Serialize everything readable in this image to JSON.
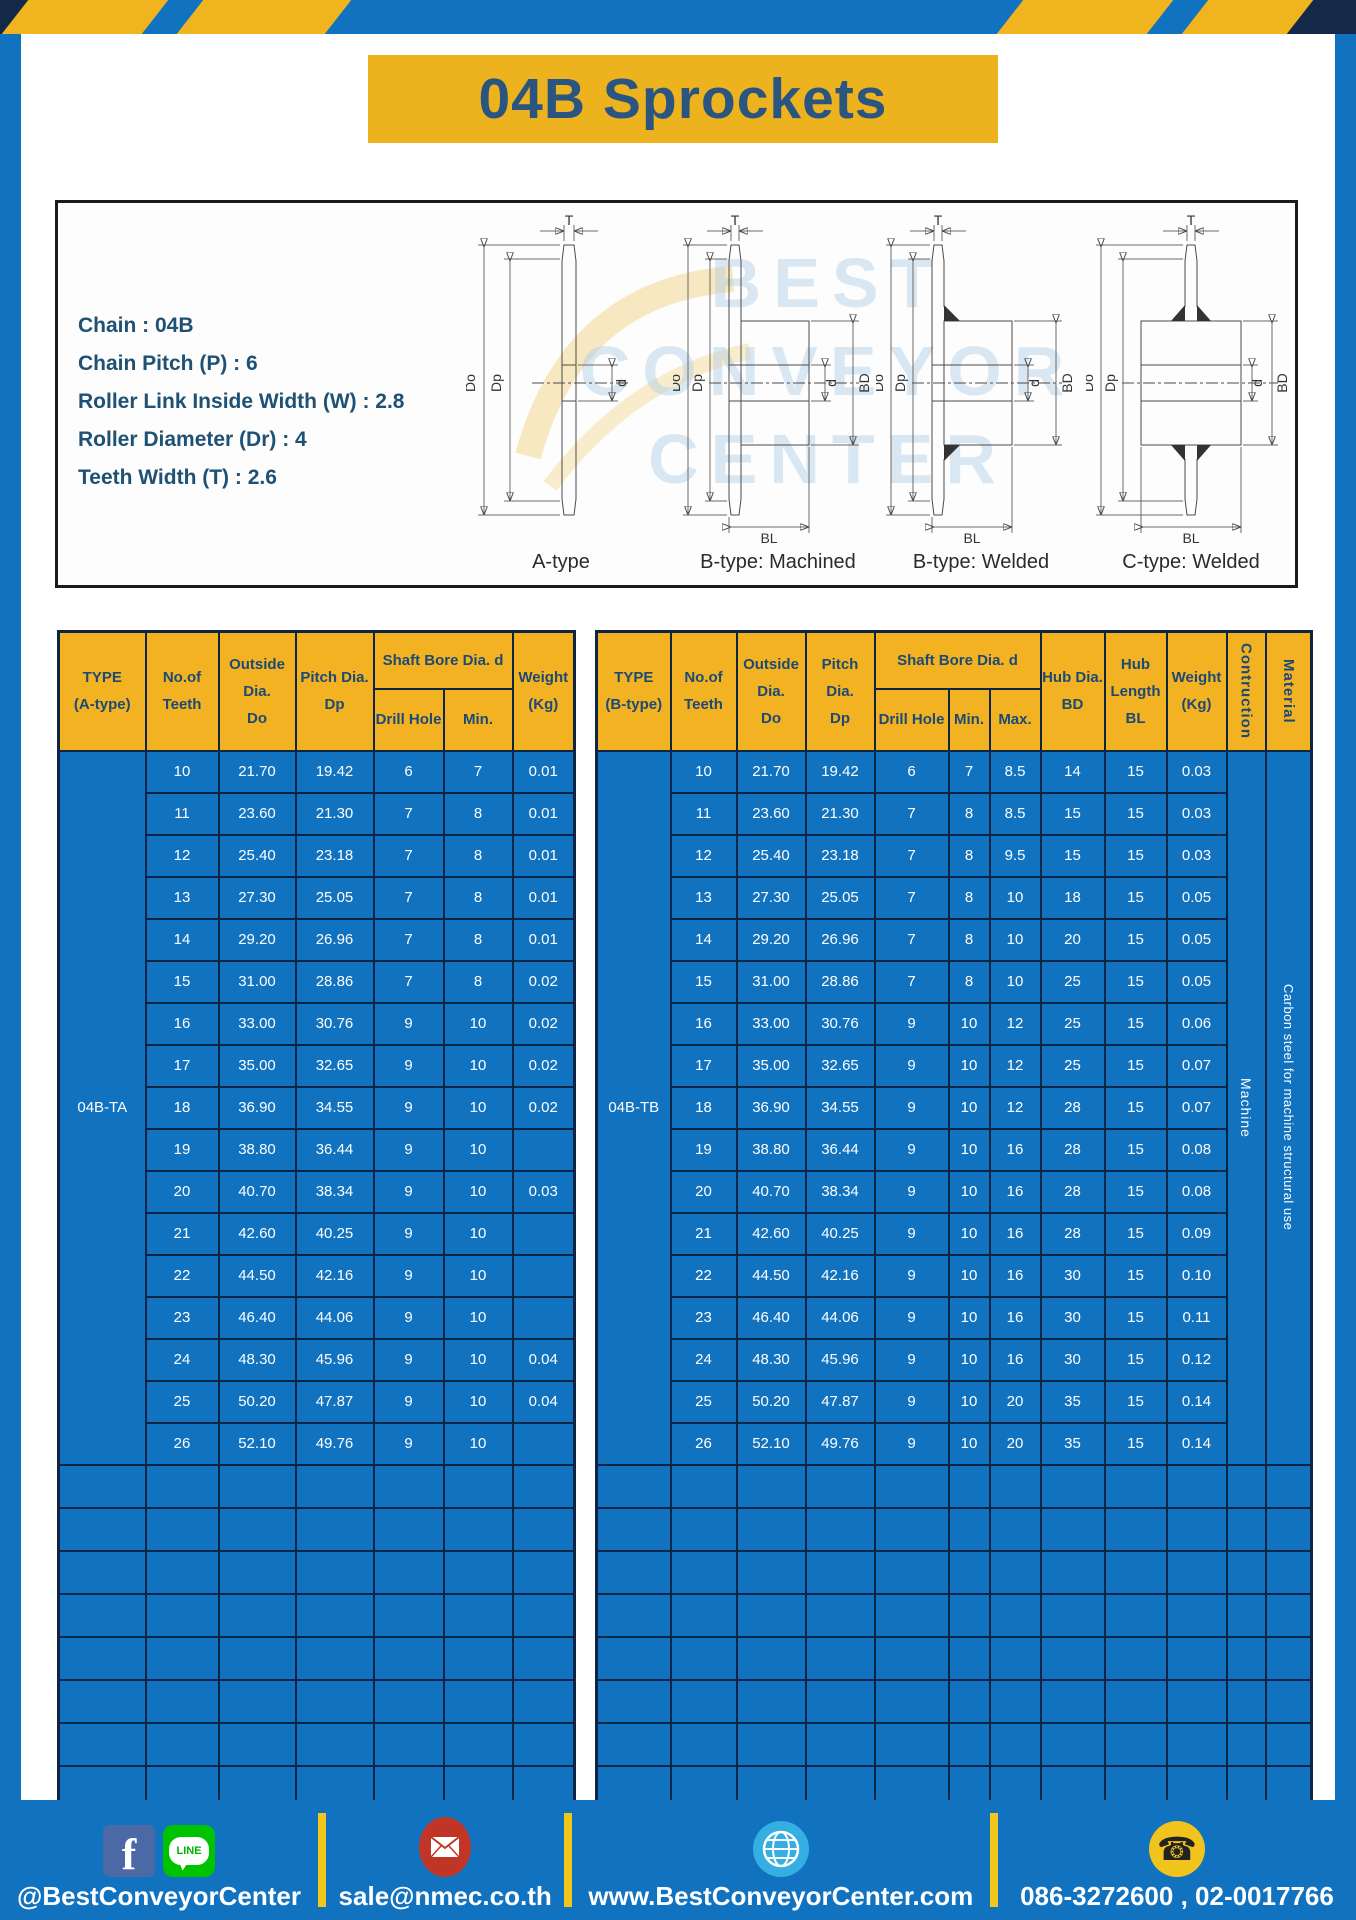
{
  "title": "04B Sprockets",
  "specs": [
    "Chain : 04B",
    "Chain Pitch (P) : 6",
    "Roller Link Inside Width (W) : 2.8",
    "Roller Diameter (Dr) : 4",
    "Teeth Width (T) : 2.6"
  ],
  "diagram": {
    "captions": [
      "A-type",
      "B-type: Machined",
      "B-type: Welded",
      "C-type: Welded"
    ],
    "labels": {
      "t": "T",
      "outer": "Do",
      "pitch": "Dp",
      "bore": "d",
      "hub_dia": "BD",
      "hub_len": "BL"
    },
    "watermark": [
      "BEST",
      "CONVEYOR",
      "CENTER"
    ]
  },
  "table_a": {
    "headers": {
      "type": "TYPE\n(A-type)",
      "teeth": "No.of\nTeeth",
      "outside": "Outside\nDia.\nDo",
      "pitch": "Pitch Dia.\nDp",
      "shaft_bore": "Shaft Bore Dia. d",
      "drill": "Drill Hole",
      "min": "Min.",
      "weight": "Weight\n(Kg)"
    },
    "type_value": "04B-TA",
    "rows": [
      [
        "10",
        "21.70",
        "19.42",
        "6",
        "7",
        "0.01"
      ],
      [
        "11",
        "23.60",
        "21.30",
        "7",
        "8",
        "0.01"
      ],
      [
        "12",
        "25.40",
        "23.18",
        "7",
        "8",
        "0.01"
      ],
      [
        "13",
        "27.30",
        "25.05",
        "7",
        "8",
        "0.01"
      ],
      [
        "14",
        "29.20",
        "26.96",
        "7",
        "8",
        "0.01"
      ],
      [
        "15",
        "31.00",
        "28.86",
        "7",
        "8",
        "0.02"
      ],
      [
        "16",
        "33.00",
        "30.76",
        "9",
        "10",
        "0.02"
      ],
      [
        "17",
        "35.00",
        "32.65",
        "9",
        "10",
        "0.02"
      ],
      [
        "18",
        "36.90",
        "34.55",
        "9",
        "10",
        "0.02"
      ],
      [
        "19",
        "38.80",
        "36.44",
        "9",
        "10",
        ""
      ],
      [
        "20",
        "40.70",
        "38.34",
        "9",
        "10",
        "0.03"
      ],
      [
        "21",
        "42.60",
        "40.25",
        "9",
        "10",
        ""
      ],
      [
        "22",
        "44.50",
        "42.16",
        "9",
        "10",
        ""
      ],
      [
        "23",
        "46.40",
        "44.06",
        "9",
        "10",
        ""
      ],
      [
        "24",
        "48.30",
        "45.96",
        "9",
        "10",
        "0.04"
      ],
      [
        "25",
        "50.20",
        "47.87",
        "9",
        "10",
        "0.04"
      ],
      [
        "26",
        "52.10",
        "49.76",
        "9",
        "10",
        ""
      ]
    ],
    "empty_rows": 8
  },
  "table_b": {
    "headers": {
      "type": "TYPE\n(B-type)",
      "teeth": "No.of\nTeeth",
      "outside": "Outside\nDia.\nDo",
      "pitch": "Pitch Dia.\nDp",
      "shaft_bore": "Shaft Bore Dia. d",
      "drill": "Drill Hole",
      "min": "Min.",
      "max": "Max.",
      "hub_dia": "Hub Dia.\nBD",
      "hub_len": "Hub\nLength\nBL",
      "weight": "Weight\n(Kg)",
      "construction": "Contruction",
      "material": "Material"
    },
    "type_value": "04B-TB",
    "construction_value": "Machine",
    "material_value": "Carbon steel for machine structural use",
    "rows": [
      [
        "10",
        "21.70",
        "19.42",
        "6",
        "7",
        "8.5",
        "14",
        "15",
        "0.03"
      ],
      [
        "11",
        "23.60",
        "21.30",
        "7",
        "8",
        "8.5",
        "15",
        "15",
        "0.03"
      ],
      [
        "12",
        "25.40",
        "23.18",
        "7",
        "8",
        "9.5",
        "15",
        "15",
        "0.03"
      ],
      [
        "13",
        "27.30",
        "25.05",
        "7",
        "8",
        "10",
        "18",
        "15",
        "0.05"
      ],
      [
        "14",
        "29.20",
        "26.96",
        "7",
        "8",
        "10",
        "20",
        "15",
        "0.05"
      ],
      [
        "15",
        "31.00",
        "28.86",
        "7",
        "8",
        "10",
        "25",
        "15",
        "0.05"
      ],
      [
        "16",
        "33.00",
        "30.76",
        "9",
        "10",
        "12",
        "25",
        "15",
        "0.06"
      ],
      [
        "17",
        "35.00",
        "32.65",
        "9",
        "10",
        "12",
        "25",
        "15",
        "0.07"
      ],
      [
        "18",
        "36.90",
        "34.55",
        "9",
        "10",
        "12",
        "28",
        "15",
        "0.07"
      ],
      [
        "19",
        "38.80",
        "36.44",
        "9",
        "10",
        "16",
        "28",
        "15",
        "0.08"
      ],
      [
        "20",
        "40.70",
        "38.34",
        "9",
        "10",
        "16",
        "28",
        "15",
        "0.08"
      ],
      [
        "21",
        "42.60",
        "40.25",
        "9",
        "10",
        "16",
        "28",
        "15",
        "0.09"
      ],
      [
        "22",
        "44.50",
        "42.16",
        "9",
        "10",
        "16",
        "30",
        "15",
        "0.10"
      ],
      [
        "23",
        "46.40",
        "44.06",
        "9",
        "10",
        "16",
        "30",
        "15",
        "0.11"
      ],
      [
        "24",
        "48.30",
        "45.96",
        "9",
        "10",
        "16",
        "30",
        "15",
        "0.12"
      ],
      [
        "25",
        "50.20",
        "47.87",
        "9",
        "10",
        "20",
        "35",
        "15",
        "0.14"
      ],
      [
        "26",
        "52.10",
        "49.76",
        "9",
        "10",
        "20",
        "35",
        "15",
        "0.14"
      ]
    ],
    "empty_rows": 8
  },
  "footer": {
    "social_text": "@BestConveyorCenter",
    "email": "sale@nmec.co.th",
    "website": "www.BestConveyorCenter.com",
    "phone": "086-3272600 , 02-0017766",
    "facebook_letter": "f",
    "line_label": "LINE"
  },
  "colors": {
    "frame_blue": "#1172c0",
    "table_blue": "#1173c0",
    "accent_yellow": "#f0b41f",
    "border_navy": "#0e2443",
    "header_text_blue": "#1d4a74",
    "title_text_blue": "#2a5580"
  }
}
